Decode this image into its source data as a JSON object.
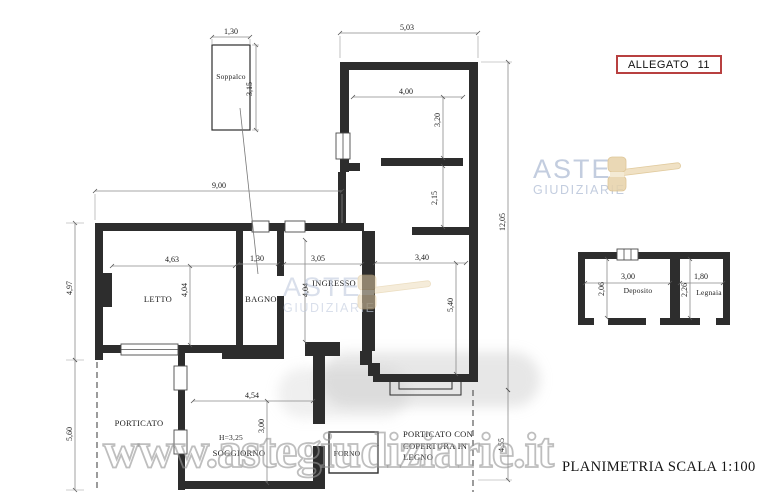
{
  "document": {
    "annex_label": "ALLEGATO 11",
    "scale_label": "PLANIMETRIA SCALA 1:100",
    "watermark_url": "www.astegiudiziarie.it"
  },
  "logo": {
    "line1": "ASTE",
    "line2": "GIUDIZIARIE",
    "icon": "gavel-icon"
  },
  "colors": {
    "annex_border": "#b84040",
    "logo_text": "#c3cddf",
    "logo_gavel": "#e9d5ae",
    "wall": "#2d2d2d",
    "dimension_line": "#8a8a8a",
    "watermark_gray": "#969696",
    "paper": "#ffffff"
  },
  "rooms": {
    "soppalco": "Soppalco",
    "letto": "LETTO",
    "bagno": "BAGNO",
    "ingresso": "INGRESSO",
    "soggiorno": "SOGGIORNO",
    "soggiorno_height": "H=3,25",
    "forno": "FORNO",
    "porticato": "PORTICATO",
    "porticato_legno_line1": "PORTICATO CON",
    "porticato_legno_line2": "COPERTURA IN",
    "porticato_legno_line3": "LEGNO",
    "deposito": "Deposito",
    "legnaia": "Legnaia"
  },
  "dimensions": {
    "soppalco_width": "1,30",
    "soppalco_depth": "3,15",
    "wing_width": "5,03",
    "wing_room_width": "4,00",
    "wing_room_depth": "3,20",
    "wing_lower_depth": "2,15",
    "body_width": "9,00",
    "total_depth": "12,05",
    "letto_width": "4,63",
    "letto_depth": "4,04",
    "bagno_width": "1,30",
    "ingresso_width": "3,05",
    "ingresso_depth": "4,04",
    "sala_width": "3,40",
    "sala_depth": "5,40",
    "left_upper_depth": "4,97",
    "left_lower_depth": "5,60",
    "soggiorno_width": "4,54",
    "soggiorno_depth": "3,00",
    "porticato_depth": "4,55",
    "deposito_width": "3,00",
    "deposito_depth": "2,06",
    "legnaia_width": "1,80",
    "legnaia_depth": "2,26"
  }
}
